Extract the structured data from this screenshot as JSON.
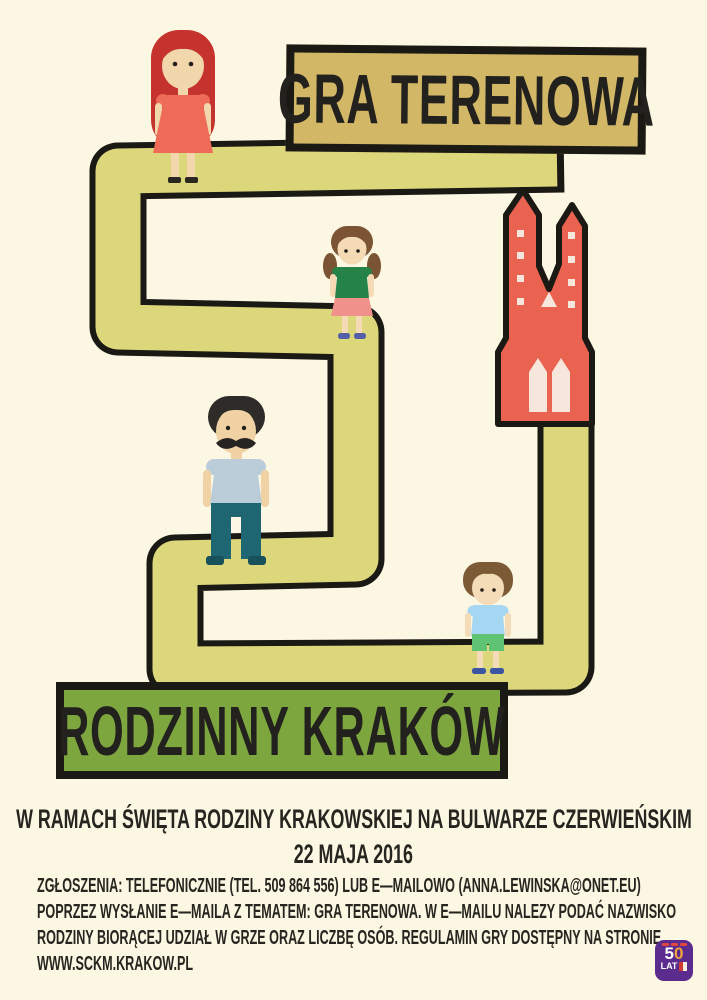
{
  "banners": {
    "top": "GRA TERENOWA",
    "bottom": "RODZINNY KRAKÓW"
  },
  "event": {
    "line1": "W RAMACH ŚWIĘTA RODZINY KRAKOWSKIEJ NA BULWARZE CZERWIEŃSKIM",
    "date": "22 MAJA 2016"
  },
  "details": {
    "line1": "ZGŁOSZENIA: TELEFONICZNIE (TEL. 509 864 556) LUB E—MAILOWO (ANNA.LEWINSKA@ONET.EU)",
    "line2": "POPRZEZ WYSŁANIE E—MAILA Z TEMATEM: GRA TERENOWA. W E—MAILU NALEZY PODAĆ NAZWISKO",
    "line3": "RODZINY BIORĄCEJ UDZIAŁ W GRZE ORAZ LICZBĘ OSÓB. REGULAMIN GRY DOSTĘPNY NA STRONIE",
    "line4": "WWW.SCKM.KRAKOW.PL"
  },
  "logo": {
    "number_five": "5",
    "number_zero": "0",
    "label": "LAT"
  },
  "colors": {
    "background": "#fbf7e3",
    "outline": "#1a1914",
    "path_fill": "#ddd77c",
    "banner_gold": "#d2b766",
    "banner_green": "#7da63f",
    "church_red": "#e96350",
    "logo_purple": "#5b2b8d",
    "text_ink": "#26251f"
  },
  "illustration": {
    "path_name": "winding-game-path",
    "figures": [
      "woman-figure",
      "girl-figure",
      "man-figure",
      "boy-figure"
    ],
    "building": "church-illustration"
  }
}
